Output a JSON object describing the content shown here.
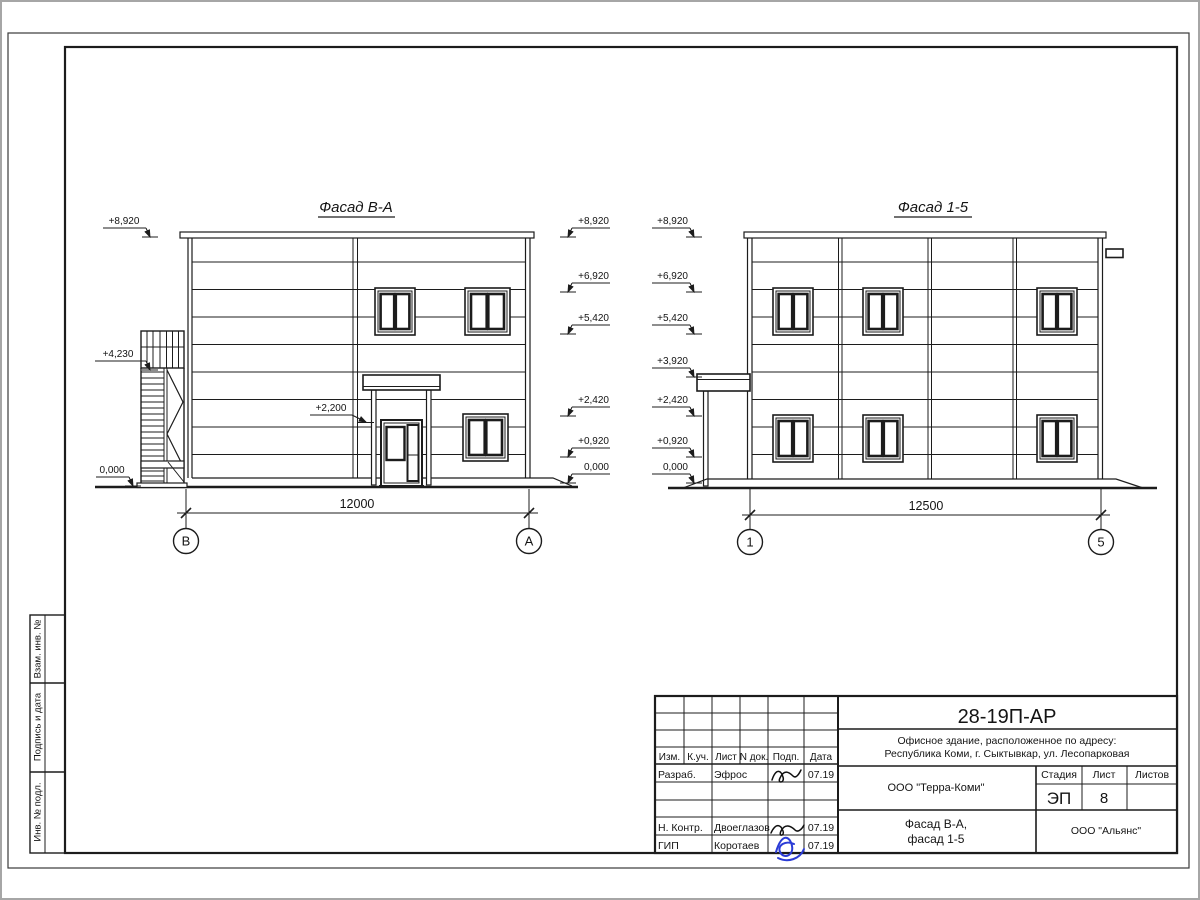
{
  "frame": {
    "stamp_col1": "Взам. инв. №",
    "stamp_col2": "Подпись и дата",
    "stamp_col3": "Инв. № подл."
  },
  "facade_ba": {
    "title": "Фасад В-А",
    "marks_left": [
      "+8,920",
      "+4,230",
      "0,000"
    ],
    "marks_right": [
      "+8,920",
      "+6,920",
      "+5,420",
      "+2,420",
      "+0,920",
      "0,000"
    ],
    "door_mark": "+2,200",
    "dim": "12000",
    "axis_left": "В",
    "axis_right": "А"
  },
  "facade_15": {
    "title": "Фасад 1-5",
    "marks_left": [
      "+8,920",
      "+6,920",
      "+5,420",
      "+3,920",
      "+2,420",
      "+0,920",
      "0,000"
    ],
    "dim": "12500",
    "axis_left": "1",
    "axis_right": "5"
  },
  "title_block": {
    "doc_code": "28-19П-АР",
    "address_line1": "Офисное здание, расположенное по адресу:",
    "address_line2": "Республика Коми, г. Сыктывкар, ул. Лесопарковая",
    "client": "ООО \"Терра-Коми\"",
    "stage_label": "Стадия",
    "sheet_label": "Лист",
    "sheets_label": "Листов",
    "stage_value": "ЭП",
    "sheet_value": "8",
    "sheets_value": "",
    "subtitle_line1": "Фасад В-А,",
    "subtitle_line2": "фасад 1-5",
    "contractor": "ООО \"Альянс\"",
    "cols": [
      "Изм.",
      "К.уч.",
      "Лист",
      "N док.",
      "Подп.",
      "Дата"
    ],
    "row_developed": {
      "role": "Разраб.",
      "name": "Эфрос",
      "date": "07.19"
    },
    "row_ncontrol": {
      "role": "Н. Контр.",
      "name": "Двоеглазов",
      "date": "07.19"
    },
    "row_gip": {
      "role": "ГИП",
      "name": "Коротаев",
      "date": "07.19"
    }
  }
}
